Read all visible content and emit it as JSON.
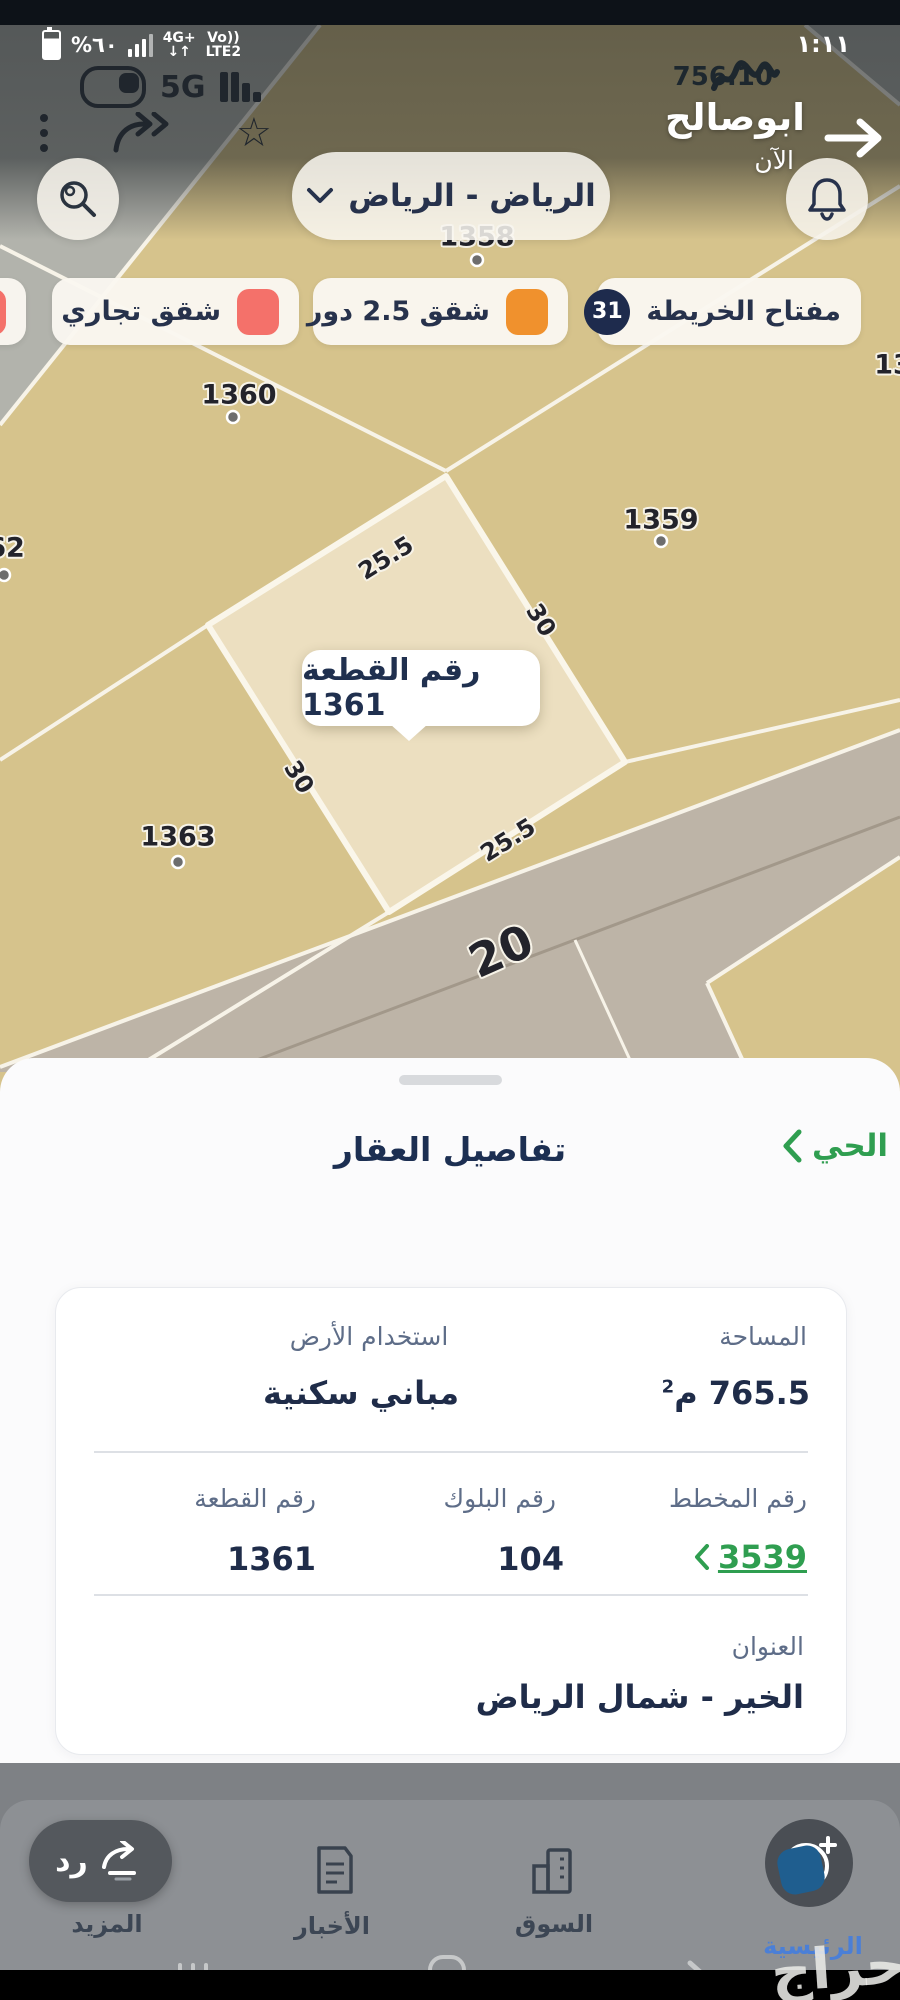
{
  "status": {
    "time": "١:١١",
    "battery": "%٦٠",
    "lte_top": "4G+",
    "lte_bottom": "↓↑",
    "vo_top": "Vo))",
    "vo_bottom": "LTE2",
    "net": "5G"
  },
  "notification": {
    "amount": "756.10",
    "sender": "ابوصالح",
    "time_ago": "الآن"
  },
  "search": {
    "location": "الرياض - الرياض"
  },
  "legend": {
    "key_label": "مفتاح الخريطة",
    "key_count": "31",
    "chip_25_label": "شقق 2.5 دور",
    "chip_commercial_label": "شقق تجاري",
    "color_25": "#f0912d",
    "color_commercial": "#f4716a"
  },
  "map": {
    "labels": {
      "n1358": "1358",
      "n1360": "1360",
      "n1359": "1359",
      "n1363": "1363",
      "n62": "62",
      "n13": "13"
    },
    "dims": {
      "top": "25.5",
      "right": "30",
      "left": "30",
      "bottom": "25.5"
    },
    "street": "20",
    "tooltip": "رقم القطعة 1361"
  },
  "sheet": {
    "title": "تفاصيل العقار",
    "district": "الحي"
  },
  "card": {
    "area_label": "المساحة",
    "area_value": "765.5",
    "area_unit": "م",
    "area_sup": "2",
    "use_label": "استخدام الأرض",
    "use_value": "مباني سكنية",
    "plan_label": "رقم المخطط",
    "plan_value": "3539",
    "block_label": "رقم البلوك",
    "block_value": "104",
    "parcel_label": "رقم القطعة",
    "parcel_value": "1361",
    "address_label": "العنوان",
    "address_value": "الخير - شمال الرياض"
  },
  "nav": {
    "home": "الرئيسية",
    "market": "السوق",
    "news": "الأخبار",
    "more": "المزيد",
    "reply": "رد"
  },
  "watermark": "حراج"
}
